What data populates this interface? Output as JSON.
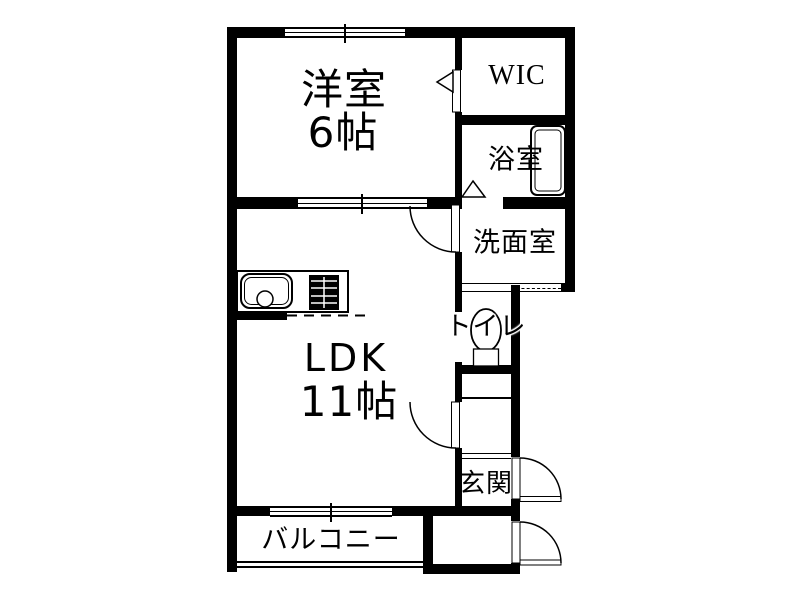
{
  "rooms": {
    "western_room": {
      "label": "洋室",
      "size": "6帖"
    },
    "ldk": {
      "label": "LDK",
      "size": "11帖"
    },
    "wic": {
      "label": "WIC"
    },
    "bathroom": {
      "label": "浴室"
    },
    "washroom": {
      "label": "洗面室"
    },
    "toilet": {
      "label": "トイレ"
    },
    "entrance": {
      "label": "玄関"
    },
    "balcony": {
      "label": "バルコニー"
    }
  },
  "colors": {
    "wall": "#000000",
    "background": "#ffffff",
    "text": "#000000"
  }
}
